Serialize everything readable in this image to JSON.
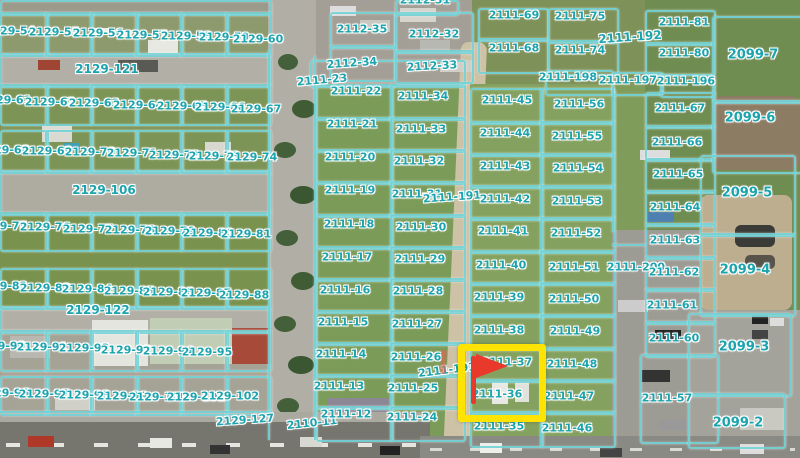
{
  "map": {
    "type": "aerial-cadastral-map",
    "colors": {
      "overlay_line": "#74d2d7",
      "label_text": "#1ba4ae",
      "label_halo": "#ffffff",
      "highlight_box": "#ffe303",
      "flag_marker": "#e8392b"
    },
    "highlighted_parcels": [
      "2111-37",
      "2111-36"
    ],
    "selection": {
      "box": {
        "x": 458,
        "y": 344,
        "w": 74,
        "h": 64
      },
      "flag": {
        "x": 471,
        "y": 354,
        "pole_h": 48
      },
      "tick": {
        "x": 441,
        "y": 350
      }
    },
    "labels": [
      [
        "2129-54",
        10,
        31
      ],
      [
        "2129-55",
        54,
        32
      ],
      [
        "2129-56",
        98,
        33
      ],
      [
        "2129-57",
        142,
        35
      ],
      [
        "2129-58",
        186,
        36
      ],
      [
        "2129-59",
        224,
        37
      ],
      [
        "2129-60",
        258,
        39
      ],
      [
        "2129-121",
        107,
        69,
        0,
        12
      ],
      [
        "2129-61",
        6,
        100
      ],
      [
        "2129-62",
        50,
        102
      ],
      [
        "2129-63",
        94,
        103
      ],
      [
        "2129-64",
        138,
        105
      ],
      [
        "2129-65",
        182,
        106
      ],
      [
        "2129-66",
        220,
        107
      ],
      [
        "2129-67",
        256,
        109
      ],
      [
        "2129-68",
        4,
        150
      ],
      [
        "2129-69",
        47,
        151
      ],
      [
        "2129-70",
        90,
        152
      ],
      [
        "2129-71",
        132,
        153
      ],
      [
        "2129-72",
        174,
        155
      ],
      [
        "2129-73",
        214,
        156
      ],
      [
        "2129-74",
        252,
        157
      ],
      [
        "2129-106",
        104,
        190,
        0,
        12
      ],
      [
        "2129-75",
        2,
        226
      ],
      [
        "2129-76",
        45,
        227
      ],
      [
        "2129-77",
        88,
        229
      ],
      [
        "2129-78",
        130,
        230
      ],
      [
        "2129-79",
        170,
        231
      ],
      [
        "2129-80",
        208,
        233
      ],
      [
        "2129-81",
        246,
        234
      ],
      [
        "2129-82",
        2,
        286
      ],
      [
        "2129-83",
        45,
        288
      ],
      [
        "2129-84",
        87,
        289
      ],
      [
        "2129-85",
        129,
        291
      ],
      [
        "2129-86",
        168,
        292
      ],
      [
        "2129-87",
        206,
        293
      ],
      [
        "2129-88",
        244,
        295
      ],
      [
        "2129-122",
        98,
        310,
        0,
        12
      ],
      [
        "2129-90",
        0,
        346
      ],
      [
        "2129-91",
        42,
        347
      ],
      [
        "2129-92",
        84,
        348
      ],
      [
        "2129-93",
        126,
        350
      ],
      [
        "2129-94",
        168,
        351
      ],
      [
        "2129-95",
        207,
        352
      ],
      [
        "2129-96",
        4,
        393
      ],
      [
        "2129-97",
        44,
        394
      ],
      [
        "2129-98",
        84,
        395
      ],
      [
        "2129-99",
        122,
        396
      ],
      [
        "2129-100",
        158,
        397
      ],
      [
        "2129-101",
        196,
        397
      ],
      [
        "2129-102",
        230,
        396
      ],
      [
        "2129-127",
        245,
        420,
        -4
      ],
      [
        "2110-11",
        312,
        423,
        -6
      ],
      [
        "2112-31",
        425,
        0
      ],
      [
        "2112-35",
        362,
        29
      ],
      [
        "2112-32",
        434,
        34
      ],
      [
        "2112-34",
        352,
        63,
        -4
      ],
      [
        "2112-33",
        432,
        66,
        -3
      ],
      [
        "2111-23",
        322,
        80,
        -5
      ],
      [
        "2111-22",
        356,
        91
      ],
      [
        "2111-21",
        352,
        124
      ],
      [
        "2111-20",
        350,
        157
      ],
      [
        "2111-19",
        350,
        190
      ],
      [
        "2111-18",
        349,
        224
      ],
      [
        "2111-17",
        347,
        257
      ],
      [
        "2111-16",
        345,
        290
      ],
      [
        "2111-15",
        343,
        322
      ],
      [
        "2111-14",
        341,
        354
      ],
      [
        "2111-13",
        339,
        386
      ],
      [
        "2111-12",
        346,
        414
      ],
      [
        "2111-34",
        423,
        96
      ],
      [
        "2111-33",
        421,
        129
      ],
      [
        "2111-32",
        419,
        161
      ],
      [
        "2111-31",
        417,
        194
      ],
      [
        "2111-30",
        421,
        227
      ],
      [
        "2111-29",
        420,
        259
      ],
      [
        "2111-28",
        418,
        291
      ],
      [
        "2111-27",
        417,
        324
      ],
      [
        "2111-26",
        416,
        357
      ],
      [
        "2111-25",
        413,
        388
      ],
      [
        "2111-24",
        412,
        417
      ],
      [
        "2111-191",
        452,
        197,
        -4
      ],
      [
        "2111-191",
        447,
        370,
        -7
      ],
      [
        "2111-45",
        507,
        100
      ],
      [
        "2111-44",
        505,
        133
      ],
      [
        "2111-43",
        505,
        166
      ],
      [
        "2111-42",
        505,
        199
      ],
      [
        "2111-41",
        503,
        231
      ],
      [
        "2111-40",
        501,
        265
      ],
      [
        "2111-39",
        499,
        297
      ],
      [
        "2111-38",
        499,
        330
      ],
      [
        "2111-37",
        507,
        362
      ],
      [
        "2111-36",
        497,
        394
      ],
      [
        "2111-35",
        499,
        426
      ],
      [
        "2111-56",
        579,
        104
      ],
      [
        "2111-55",
        577,
        136
      ],
      [
        "2111-54",
        578,
        168
      ],
      [
        "2111-53",
        577,
        201
      ],
      [
        "2111-52",
        576,
        233
      ],
      [
        "2111-51",
        574,
        267
      ],
      [
        "2111-50",
        574,
        299
      ],
      [
        "2111-49",
        575,
        331
      ],
      [
        "2111-48",
        572,
        364
      ],
      [
        "2111-47",
        569,
        396
      ],
      [
        "2111-46",
        567,
        428
      ],
      [
        "2111-200",
        636,
        267
      ],
      [
        "2111-69",
        514,
        15
      ],
      [
        "2111-75",
        580,
        16
      ],
      [
        "2111-81",
        684,
        22
      ],
      [
        "2111-192",
        630,
        37,
        -4,
        12
      ],
      [
        "2111-68",
        514,
        48
      ],
      [
        "2111-74",
        580,
        50
      ],
      [
        "2111-80",
        684,
        53
      ],
      [
        "2099-7",
        753,
        55,
        0,
        13
      ],
      [
        "2111-198",
        568,
        77
      ],
      [
        "2111-197",
        628,
        80
      ],
      [
        "2111-196",
        686,
        81
      ],
      [
        "2111-67",
        680,
        108
      ],
      [
        "2099-6",
        750,
        118,
        0,
        13
      ],
      [
        "2111-66",
        677,
        142
      ],
      [
        "2111-65",
        678,
        174
      ],
      [
        "2099-5",
        747,
        193,
        0,
        13
      ],
      [
        "2111-64",
        675,
        207
      ],
      [
        "2111-63",
        675,
        240
      ],
      [
        "2111-62",
        674,
        272
      ],
      [
        "2099-4",
        745,
        270,
        0,
        13
      ],
      [
        "2111-61",
        672,
        305
      ],
      [
        "2111-60",
        674,
        338
      ],
      [
        "2099-3",
        744,
        347,
        0,
        13
      ],
      [
        "2111-57",
        667,
        398
      ],
      [
        "2099-2",
        738,
        423,
        0,
        13
      ]
    ],
    "parcels": [
      [
        0,
        0,
        268,
        12
      ],
      [
        0,
        53,
        268,
        31
      ],
      [
        0,
        170,
        268,
        42
      ],
      [
        0,
        306,
        268,
        24
      ],
      [
        0,
        12,
        45,
        41
      ],
      [
        45,
        12,
        45,
        41
      ],
      [
        90,
        12,
        45,
        41
      ],
      [
        135,
        12,
        45,
        41
      ],
      [
        180,
        12,
        45,
        41
      ],
      [
        225,
        12,
        43,
        41
      ],
      [
        0,
        84,
        45,
        38
      ],
      [
        45,
        84,
        45,
        38
      ],
      [
        90,
        84,
        45,
        38
      ],
      [
        135,
        84,
        45,
        38
      ],
      [
        180,
        84,
        45,
        38
      ],
      [
        225,
        84,
        43,
        38
      ],
      [
        0,
        130,
        45,
        40
      ],
      [
        45,
        130,
        45,
        40
      ],
      [
        90,
        130,
        45,
        40
      ],
      [
        135,
        130,
        45,
        40
      ],
      [
        180,
        130,
        45,
        40
      ],
      [
        225,
        130,
        43,
        40
      ],
      [
        0,
        212,
        45,
        36
      ],
      [
        45,
        212,
        45,
        36
      ],
      [
        90,
        212,
        45,
        36
      ],
      [
        135,
        212,
        45,
        36
      ],
      [
        180,
        212,
        45,
        36
      ],
      [
        225,
        212,
        43,
        36
      ],
      [
        0,
        268,
        45,
        38
      ],
      [
        45,
        268,
        45,
        38
      ],
      [
        90,
        268,
        45,
        38
      ],
      [
        135,
        268,
        45,
        38
      ],
      [
        180,
        268,
        45,
        38
      ],
      [
        225,
        268,
        43,
        38
      ],
      [
        0,
        330,
        45,
        38
      ],
      [
        45,
        330,
        45,
        38
      ],
      [
        90,
        330,
        45,
        38
      ],
      [
        135,
        330,
        45,
        38
      ],
      [
        180,
        330,
        45,
        38
      ],
      [
        225,
        330,
        43,
        38
      ],
      [
        0,
        376,
        45,
        36
      ],
      [
        45,
        376,
        45,
        36
      ],
      [
        90,
        376,
        45,
        36
      ],
      [
        135,
        376,
        45,
        36
      ],
      [
        180,
        376,
        45,
        36
      ],
      [
        225,
        376,
        43,
        36
      ],
      [
        310,
        60,
        152,
        24
      ],
      [
        316,
        84,
        74,
        33
      ],
      [
        316,
        117,
        74,
        32
      ],
      [
        316,
        149,
        74,
        32
      ],
      [
        316,
        181,
        74,
        33
      ],
      [
        316,
        214,
        74,
        32
      ],
      [
        316,
        246,
        74,
        32
      ],
      [
        316,
        278,
        74,
        32
      ],
      [
        316,
        310,
        74,
        32
      ],
      [
        316,
        342,
        74,
        32
      ],
      [
        316,
        374,
        74,
        32
      ],
      [
        316,
        406,
        74,
        32
      ],
      [
        390,
        84,
        72,
        33
      ],
      [
        390,
        117,
        72,
        32
      ],
      [
        390,
        149,
        72,
        32
      ],
      [
        390,
        181,
        72,
        33
      ],
      [
        390,
        214,
        72,
        32
      ],
      [
        390,
        246,
        72,
        32
      ],
      [
        390,
        278,
        72,
        32
      ],
      [
        390,
        310,
        72,
        32
      ],
      [
        390,
        342,
        72,
        32
      ],
      [
        390,
        374,
        72,
        32
      ],
      [
        390,
        406,
        72,
        32
      ],
      [
        470,
        88,
        70,
        33
      ],
      [
        470,
        121,
        70,
        32
      ],
      [
        470,
        153,
        70,
        32
      ],
      [
        470,
        185,
        70,
        32
      ],
      [
        470,
        217,
        70,
        33
      ],
      [
        470,
        250,
        70,
        32
      ],
      [
        470,
        282,
        70,
        32
      ],
      [
        470,
        314,
        70,
        33
      ],
      [
        470,
        347,
        70,
        32
      ],
      [
        470,
        379,
        70,
        32
      ],
      [
        470,
        411,
        70,
        33
      ],
      [
        540,
        88,
        72,
        33
      ],
      [
        540,
        121,
        72,
        32
      ],
      [
        540,
        153,
        72,
        32
      ],
      [
        540,
        185,
        72,
        32
      ],
      [
        540,
        217,
        72,
        33
      ],
      [
        540,
        250,
        72,
        32
      ],
      [
        540,
        282,
        72,
        32
      ],
      [
        540,
        314,
        72,
        33
      ],
      [
        540,
        347,
        72,
        32
      ],
      [
        540,
        379,
        72,
        32
      ],
      [
        540,
        411,
        72,
        33
      ],
      [
        478,
        8,
        67,
        30
      ],
      [
        478,
        38,
        67,
        32
      ],
      [
        548,
        8,
        67,
        32
      ],
      [
        548,
        40,
        67,
        32
      ],
      [
        645,
        10,
        67,
        32
      ],
      [
        645,
        42,
        67,
        30
      ],
      [
        545,
        70,
        65,
        22
      ],
      [
        612,
        72,
        48,
        20
      ],
      [
        660,
        74,
        52,
        20
      ],
      [
        712,
        16,
        88,
        84
      ],
      [
        645,
        92,
        67,
        33
      ],
      [
        645,
        125,
        67,
        33
      ],
      [
        645,
        158,
        67,
        32
      ],
      [
        645,
        190,
        67,
        33
      ],
      [
        645,
        223,
        67,
        33
      ],
      [
        645,
        256,
        67,
        32
      ],
      [
        645,
        288,
        67,
        33
      ],
      [
        645,
        321,
        67,
        33
      ],
      [
        640,
        354,
        75,
        86
      ],
      [
        712,
        100,
        88,
        70
      ],
      [
        700,
        155,
        92,
        78
      ],
      [
        700,
        233,
        92,
        80
      ],
      [
        688,
        313,
        100,
        80
      ],
      [
        688,
        393,
        94,
        52
      ],
      [
        330,
        12,
        62,
        33
      ],
      [
        395,
        12,
        75,
        38
      ],
      [
        330,
        45,
        62,
        33
      ],
      [
        395,
        50,
        75,
        30
      ],
      [
        395,
        0,
        60,
        12
      ]
    ],
    "lines": [
      [
        268,
        50,
        2,
        390
      ],
      [
        314,
        56,
        2,
        384
      ],
      [
        0,
        411,
        272,
        2
      ],
      [
        612,
        244,
        34,
        2
      ],
      [
        612,
        84,
        2,
        148
      ]
    ]
  }
}
